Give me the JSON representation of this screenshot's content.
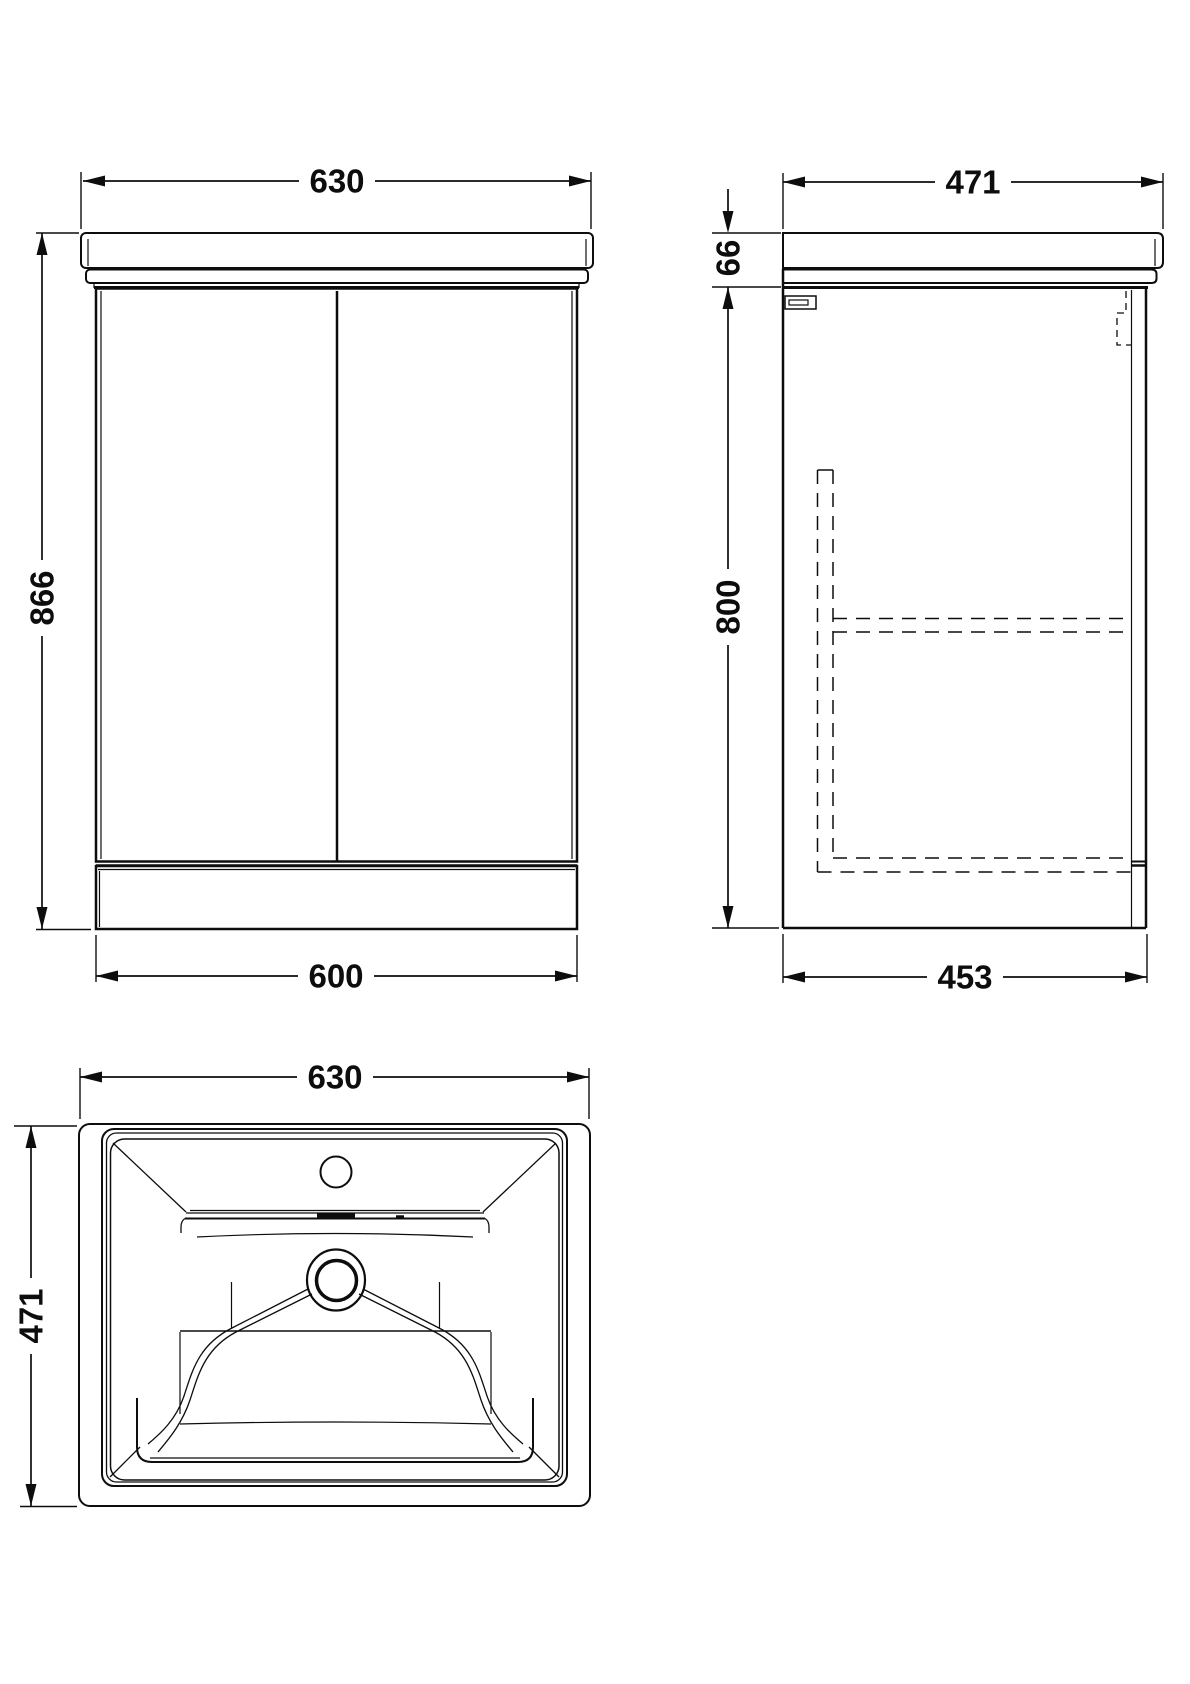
{
  "drawing_type": "technical dimension drawing - bathroom vanity unit with basin",
  "units": "mm",
  "line_color": "#0d0d0d",
  "views": {
    "front": {
      "name": "front elevation",
      "dim_width_top": "630",
      "dim_height": "866",
      "dim_width_bottom": "600"
    },
    "side": {
      "name": "side elevation",
      "dim_depth_top": "471",
      "dim_counter_height": "66",
      "dim_body_height": "800",
      "dim_depth_bottom": "453"
    },
    "plan": {
      "name": "basin plan view",
      "dim_width": "630",
      "dim_depth": "471"
    }
  }
}
